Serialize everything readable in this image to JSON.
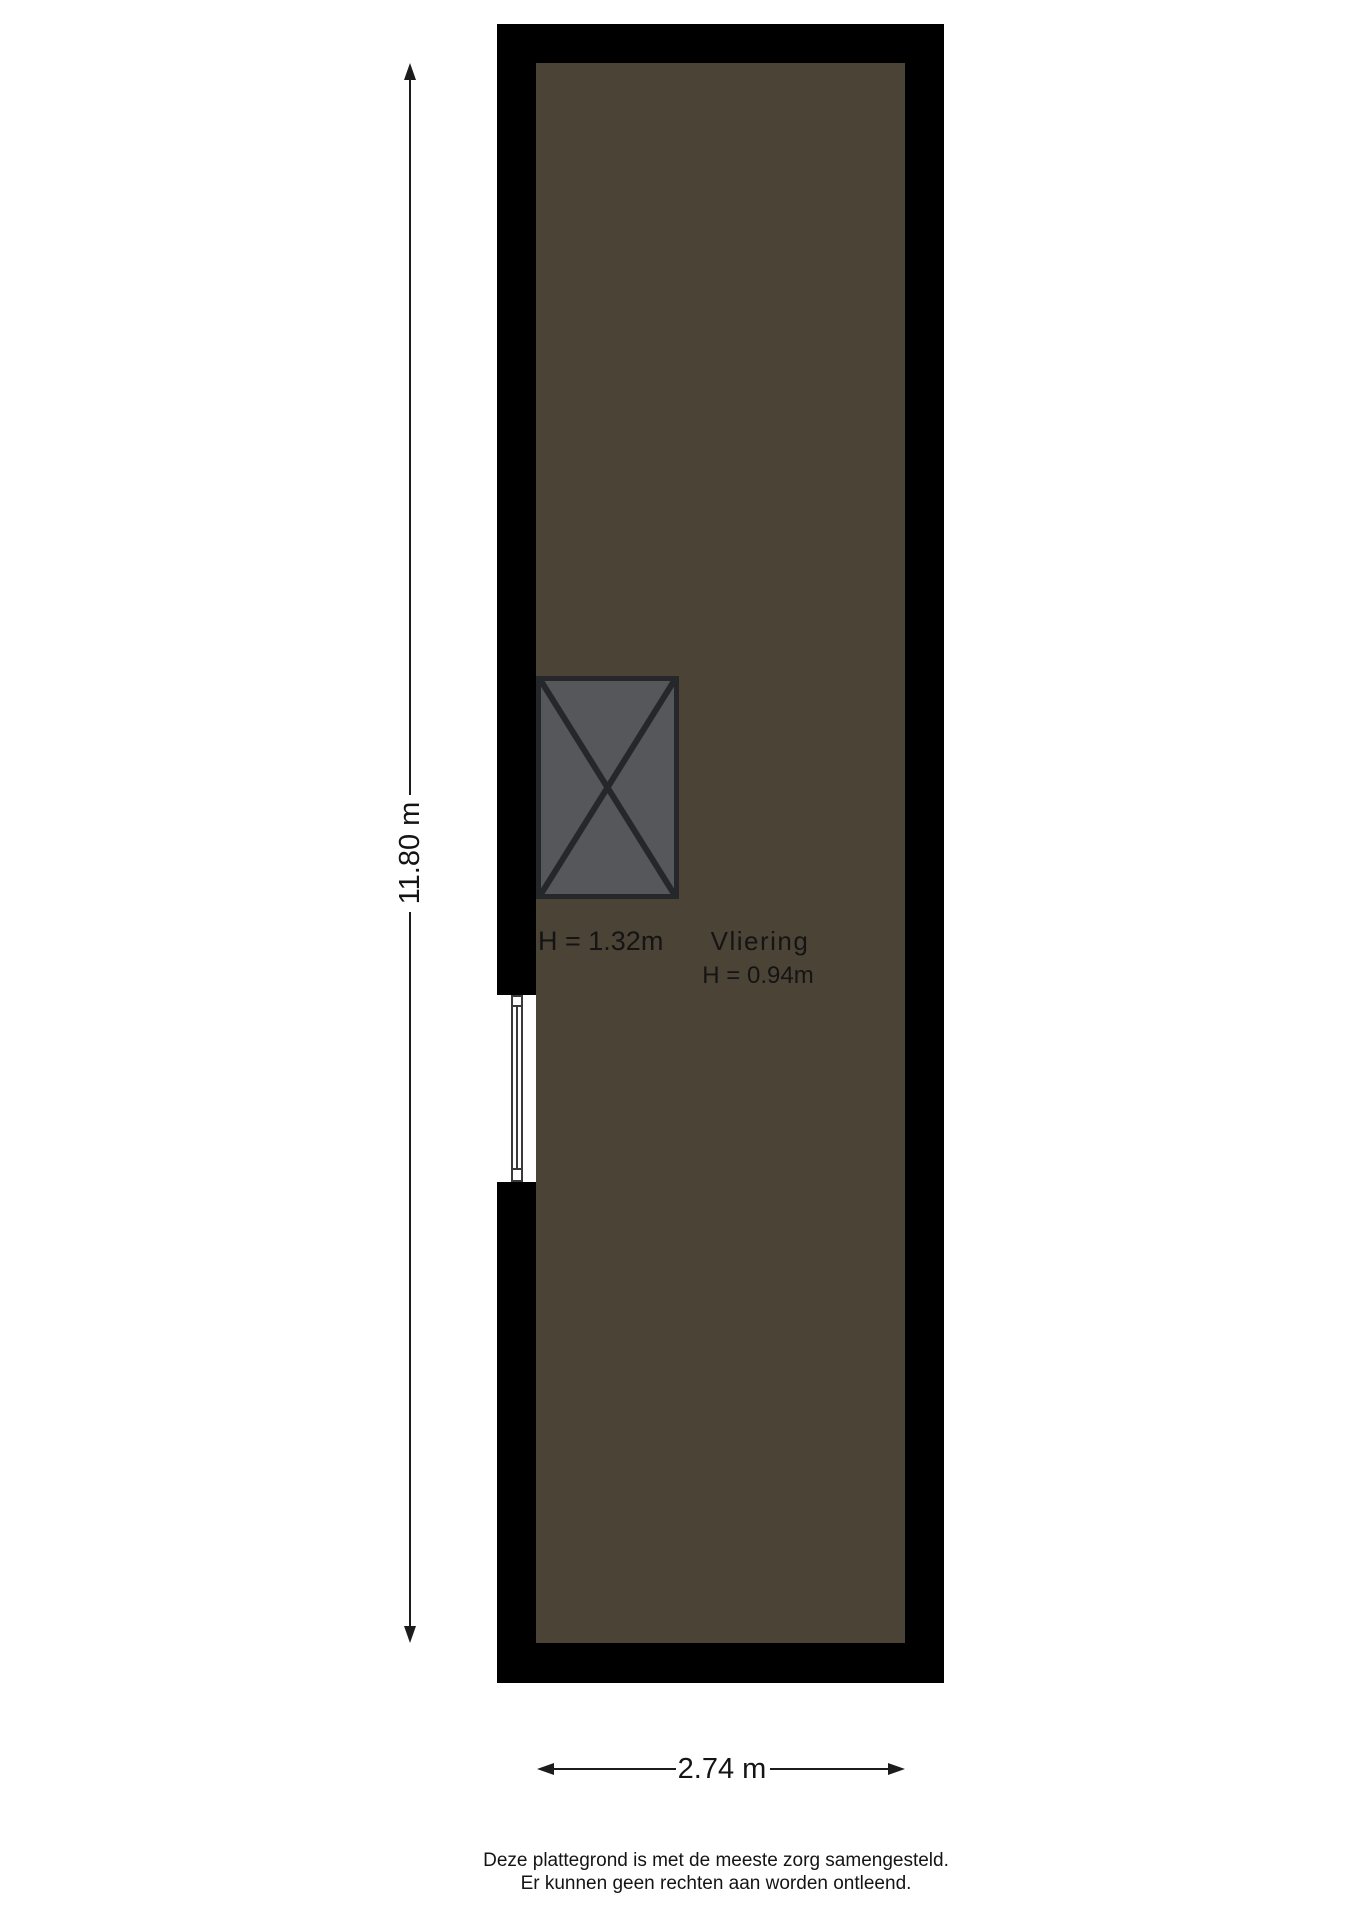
{
  "plan": {
    "room": {
      "name": "Vliering",
      "ceiling_height": "H = 0.94m"
    },
    "stairs_area": {
      "ceiling_height": "H = 1.32m"
    },
    "dimensions": {
      "height_label": "11.80 m",
      "width_label": "2.74 m"
    },
    "colors": {
      "wall": "#000000",
      "floor": "#4b4336",
      "stairs_fill": "#56575b",
      "stairs_line": "#26272b",
      "text": "#141414"
    }
  },
  "footer": {
    "disclaimer_line1": "Deze plattegrond is met de meeste zorg samengesteld.",
    "disclaimer_line2": "Er kunnen geen rechten aan worden ontleend."
  }
}
